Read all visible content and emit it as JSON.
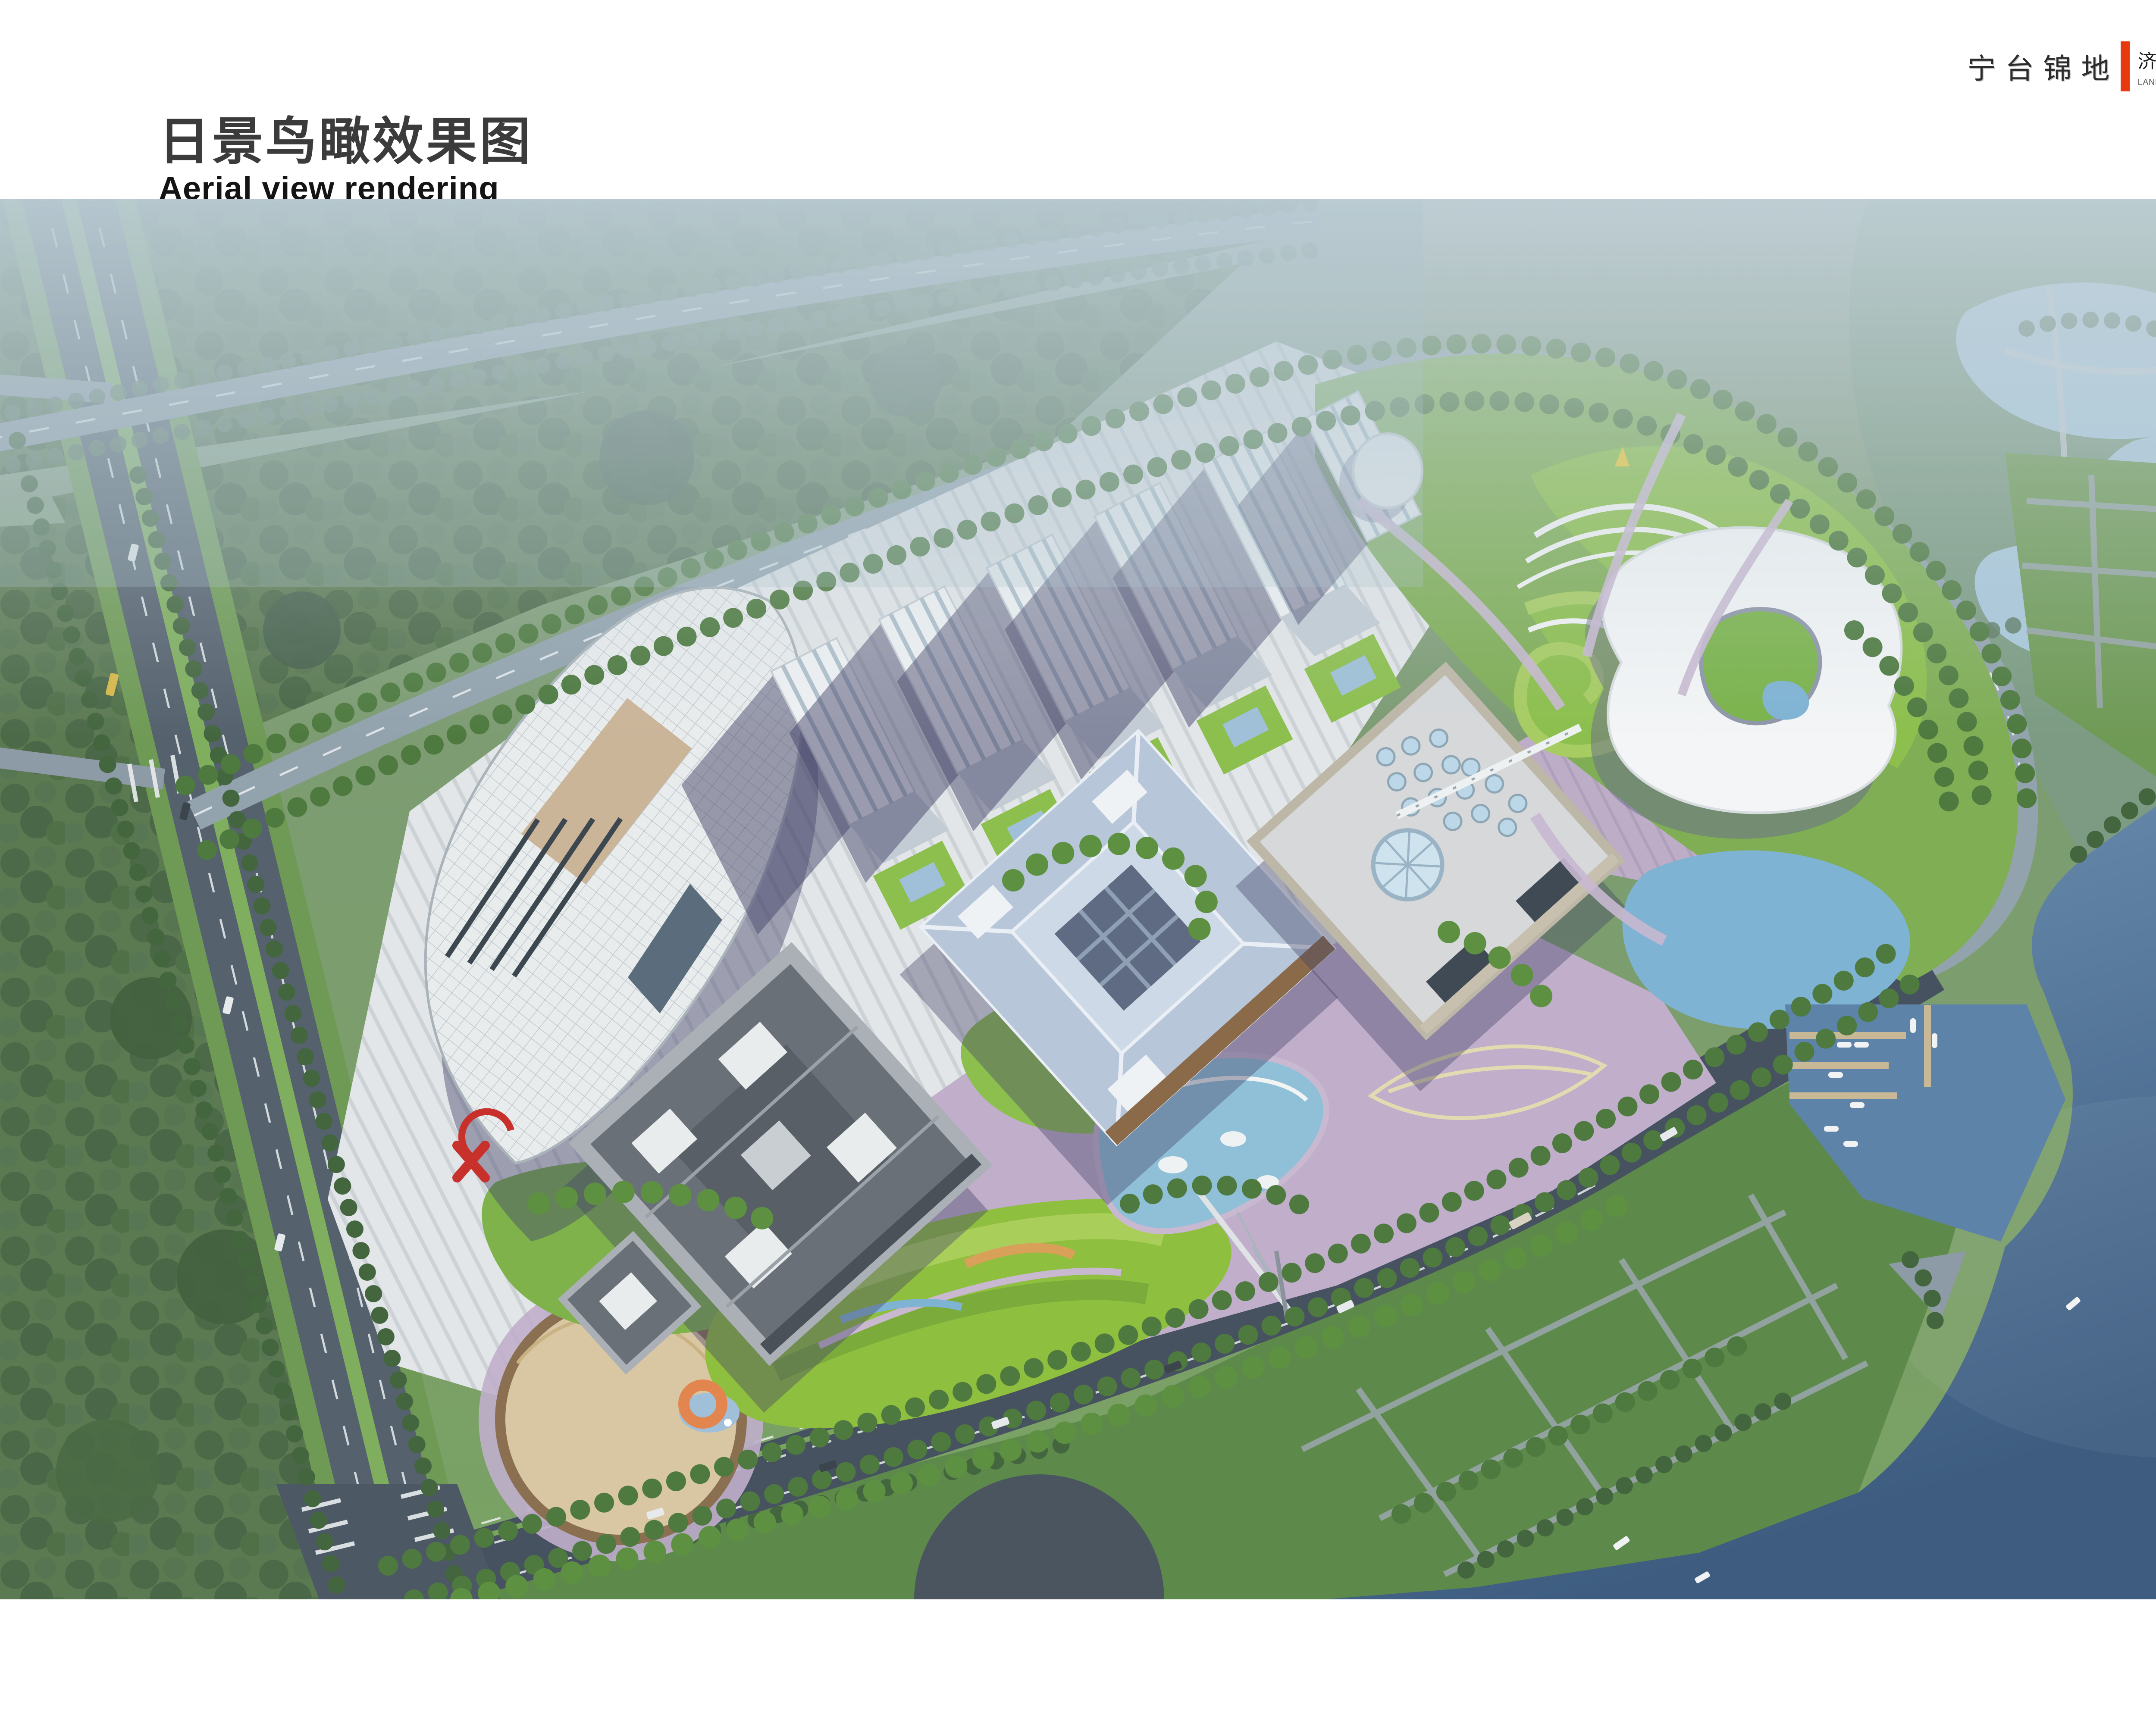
{
  "header": {
    "title_zh": "日景鸟瞰效果图",
    "title_en": "Aerial view rendering"
  },
  "logo": {
    "brand_zh": "宁台锦地",
    "project_zh": "济宁文化中心景观设计",
    "project_en": "LANDSCAPE DESIGN OF JINING CULTURAL CENTER",
    "accent_color": "#e8380d"
  },
  "palette": {
    "water_deep": "#3f5f85",
    "water_mid": "#5d83a8",
    "pond": "#8fc0d8",
    "lawn": "#8cbf4d",
    "meadow": "#8fbf3e",
    "forest": "#55724f",
    "road_light": "#93a3ae",
    "road_dark": "#46525f",
    "pavement": "#e2e5e7",
    "lavender": "#c0aecb",
    "roof_blue": "#b7c6d9",
    "shadow": "#45456a",
    "accent_orange": "#e2854f",
    "accent_red": "#c8312b"
  }
}
